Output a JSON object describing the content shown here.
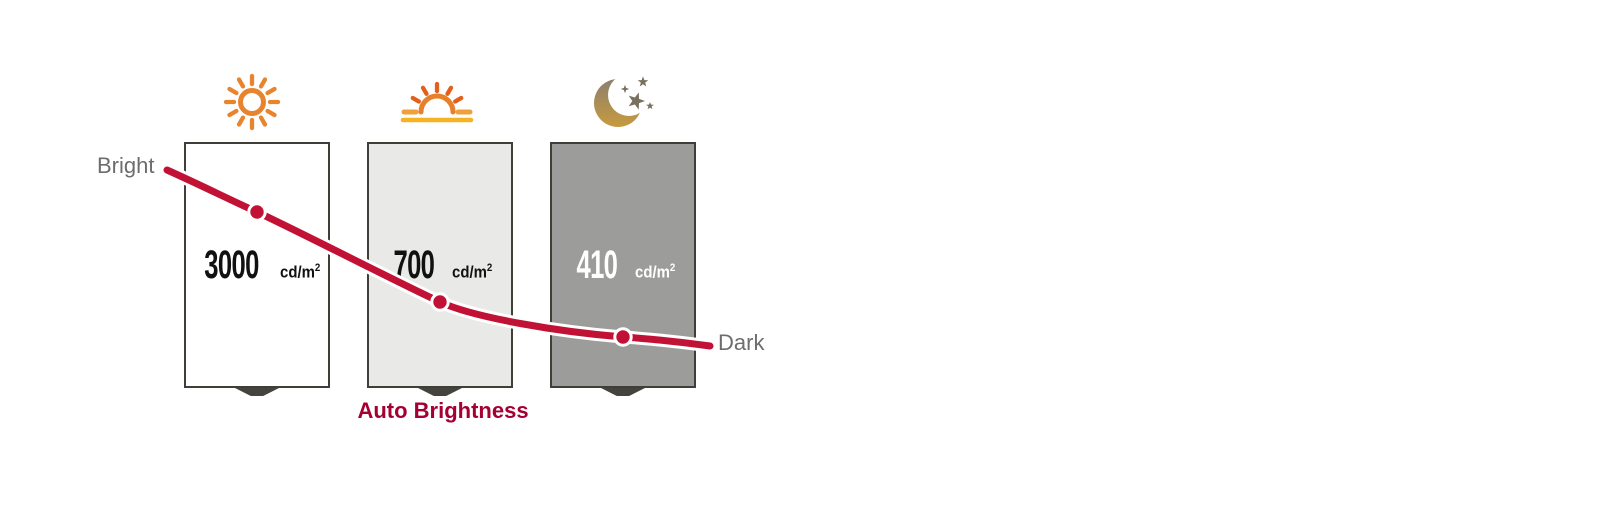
{
  "diagram": {
    "left_label": "Bright",
    "right_label": "Dark",
    "caption": "Auto Brightness",
    "curve_color": "#c11236",
    "caption_color": "#a50034",
    "conditions": [
      {
        "icon": "sun-icon",
        "icon_color": "#e8842e",
        "value": "3000",
        "unit": "cd/m",
        "unit_exponent": "2",
        "panel_color": "#ffffff",
        "value_color": "#111111"
      },
      {
        "icon": "sunrise-icon",
        "icon_color": "#e8802a",
        "value": "700",
        "unit": "cd/m",
        "unit_exponent": "2",
        "panel_color": "#e9e9e7",
        "value_color": "#111111"
      },
      {
        "icon": "moon-stars-icon",
        "icon_color": "#c79a3d",
        "value": "410",
        "unit": "cd/m",
        "unit_exponent": "2",
        "panel_color": "#9c9c9a",
        "value_color": "#ffffff"
      }
    ]
  }
}
